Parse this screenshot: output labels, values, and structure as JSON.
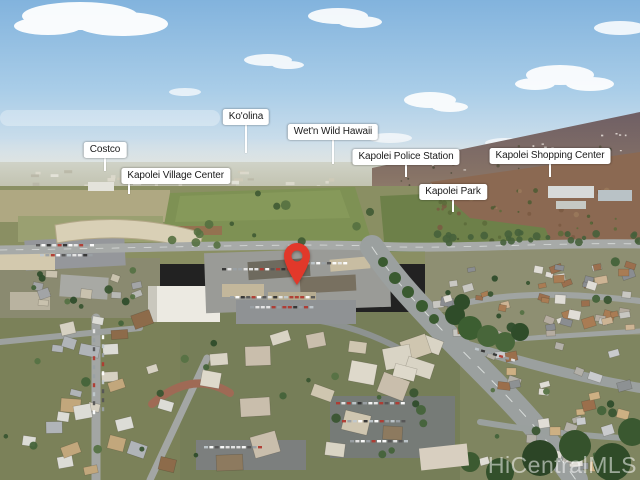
{
  "image": {
    "type": "aerial-drone-photo",
    "location": "Kapolei, Oahu, Hawaii",
    "watermark": "HiCentralMLS"
  },
  "map_labels": [
    {
      "text": "Costco",
      "anchor_x": 105,
      "top": 142,
      "line_len": 13,
      "line_offset_pct": 50
    },
    {
      "text": "Ko'olina",
      "anchor_x": 246,
      "top": 109,
      "line_len": 28,
      "line_offset_pct": 50
    },
    {
      "text": "Wet'n Wild Hawaii",
      "anchor_x": 333,
      "top": 124,
      "line_len": 24,
      "line_offset_pct": 50
    },
    {
      "text": "Kapolei Police Station",
      "anchor_x": 406,
      "top": 149,
      "line_len": 12,
      "line_offset_pct": 50
    },
    {
      "text": "Kapolei Shopping Center",
      "anchor_x": 550,
      "top": 148,
      "line_len": 13,
      "line_offset_pct": 50
    },
    {
      "text": "Kapolei Village Center",
      "anchor_x": 129,
      "top": 168,
      "line_len": 10,
      "line_offset_pct": 7
    },
    {
      "text": "Kapolei Park",
      "anchor_x": 453,
      "top": 184,
      "line_len": 12,
      "line_offset_pct": 50
    }
  ],
  "pin": {
    "x": 297,
    "y": 285,
    "color": "#e2382a",
    "name": "subject-property-pin"
  },
  "colors": {
    "label_bg": "#ffffff",
    "label_text": "#1b1b1b",
    "leader_line": "#ffffff",
    "watermark_text": "rgba(255,255,255,0.52)"
  }
}
